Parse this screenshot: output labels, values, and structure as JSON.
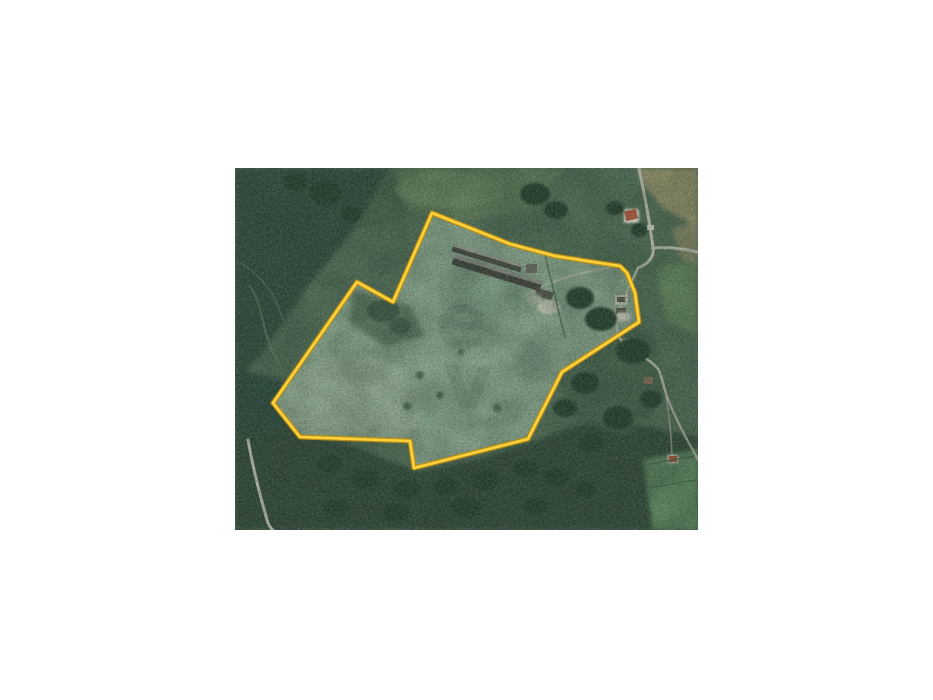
{
  "window": {
    "background": "#ffffff"
  },
  "photo": {
    "description": "Aerial satellite photograph of rural farmland with a property parcel outlined in yellow",
    "x": 235,
    "y": 168,
    "width": 463,
    "height": 362
  },
  "watermark": {
    "letters": [
      "e",
      "v"
    ],
    "color": "#0c2418",
    "opacity": 0.08
  },
  "parcel": {
    "points": [
      [
        197,
        45
      ],
      [
        235,
        60
      ],
      [
        275,
        76
      ],
      [
        320,
        88
      ],
      [
        365,
        95
      ],
      [
        385,
        98
      ],
      [
        392,
        105
      ],
      [
        400,
        125
      ],
      [
        404,
        154
      ],
      [
        327,
        204
      ],
      [
        293,
        271
      ],
      [
        179,
        300
      ],
      [
        175,
        273
      ],
      [
        65,
        269
      ],
      [
        38,
        235
      ],
      [
        122,
        114
      ],
      [
        158,
        134
      ]
    ],
    "fill": "#87a38c",
    "stroke_outer": "#bf8e0e",
    "stroke_inner": "#ffd23e"
  },
  "colors": {
    "base_green": "#4e6a54",
    "forest_dark": "#2e463a",
    "field_light": "#8fa98f",
    "tan_field": "#96926b",
    "road": "#cbcabc",
    "roof_red": "#b25036",
    "barn_dark": "#44443f",
    "bright_field": "#5d865e"
  }
}
